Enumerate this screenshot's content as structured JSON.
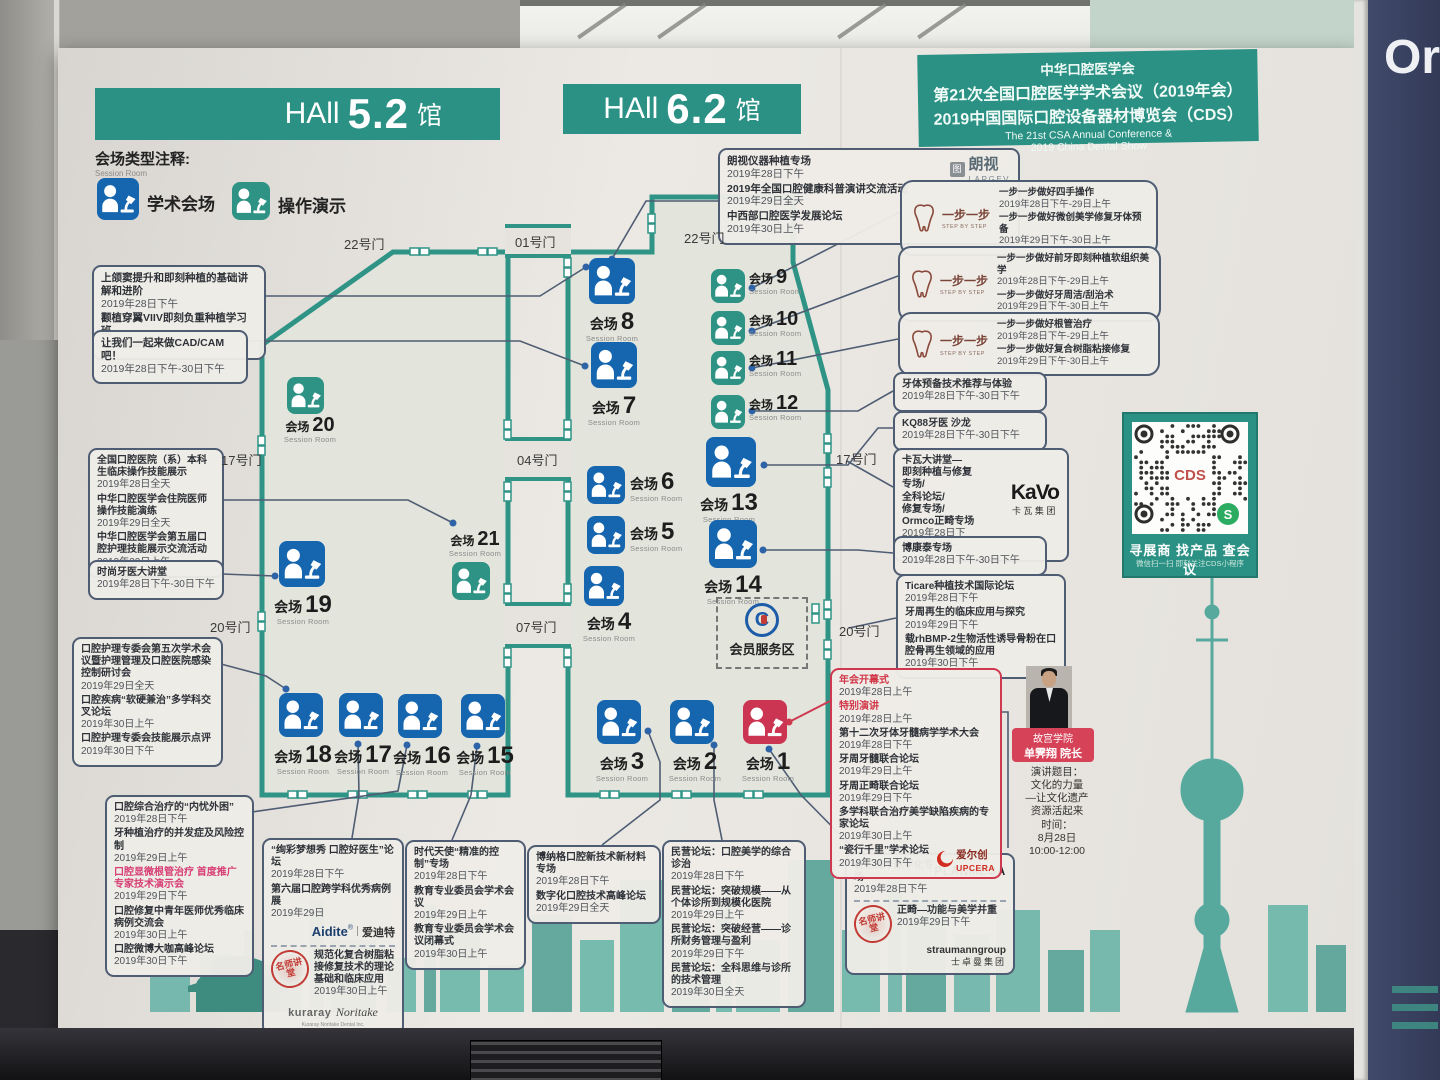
{
  "wall_text": "Or",
  "conference_header": {
    "l1": "中华口腔医学会",
    "l2": "第21次全国口腔医学学术会议（2019年会）",
    "l3": "2019中国国际口腔设备器材博览会（CDS）",
    "l4": "The 21st CSA Annual Conference &",
    "l5": "2019 China Dental Show"
  },
  "hall_titles": {
    "h52": {
      "pre": "HAll",
      "num": "5.2",
      "post": "馆"
    },
    "h62": {
      "pre": "HAll",
      "num": "6.2",
      "post": "馆"
    }
  },
  "legend": {
    "title": "会场类型注释:",
    "subtitle": "Session Room",
    "academic": "学术会场",
    "demo": "操作演示"
  },
  "room_label": "会场",
  "room_sub": "Session Room",
  "rooms": [
    {
      "num": "1",
      "type": "red"
    },
    {
      "num": "2",
      "type": "blue"
    },
    {
      "num": "3",
      "type": "blue"
    },
    {
      "num": "4",
      "type": "blue"
    },
    {
      "num": "5",
      "type": "blue"
    },
    {
      "num": "6",
      "type": "blue"
    },
    {
      "num": "7",
      "type": "blue"
    },
    {
      "num": "8",
      "type": "blue"
    },
    {
      "num": "9",
      "type": "teal"
    },
    {
      "num": "10",
      "type": "teal"
    },
    {
      "num": "11",
      "type": "teal"
    },
    {
      "num": "12",
      "type": "teal"
    },
    {
      "num": "13",
      "type": "blue"
    },
    {
      "num": "14",
      "type": "blue"
    },
    {
      "num": "15",
      "type": "blue"
    },
    {
      "num": "16",
      "type": "blue"
    },
    {
      "num": "17",
      "type": "blue"
    },
    {
      "num": "18",
      "type": "blue"
    },
    {
      "num": "19",
      "type": "blue"
    },
    {
      "num": "20",
      "type": "teal"
    },
    {
      "num": "21",
      "type": "teal"
    }
  ],
  "doors": [
    "22号门",
    "01号门",
    "22号门",
    "04号门",
    "07号门",
    "17号门",
    "20号门",
    "17号门",
    "20号门"
  ],
  "member_area": {
    "label": "会员服务区"
  },
  "qr": {
    "title": "寻展商 找产品 查会议",
    "subtitle": "微信扫一扫 即刻关注CDS小程序",
    "center": "CDS",
    "wechat": "S"
  },
  "speaker": {
    "org": "故宫学院",
    "name": "单霁翔 院长",
    "lines": [
      "演讲题目：",
      "文化的力量",
      "—让文化遗产",
      "资源活起来",
      "时间：",
      "8月28日",
      "10:00-12:00"
    ]
  },
  "logos": {
    "largev": {
      "cn": "朗视",
      "en": "LARGEV",
      "ic": "图"
    },
    "step": {
      "cn": "一步一步",
      "en": "STEP BY STEP"
    },
    "kavo": {
      "en": "KaVo",
      "cn": "卡瓦集团"
    },
    "upcera": {
      "cn": "爱尔创",
      "en": "UPCERA"
    },
    "aidite": {
      "en": "Aidite",
      "cn": "爱迪特"
    },
    "mingshi": {
      "cn": "名师讲堂"
    },
    "kuraray": {
      "en1": "kuraray",
      "en2": "Noritake",
      "tag": "Kuraray Noritake Dental Inc."
    },
    "planmeca": {
      "en": "PLANMECA"
    },
    "straumann": {
      "en": "straumanngroup",
      "cn": "士卓曼集团"
    },
    "csa_c": "C"
  },
  "boxes": {
    "b1": {
      "lines": [
        {
          "t": "上颌窦提升和即刻种植的基础讲解和进阶",
          "d": "2019年28日下午"
        },
        {
          "t": "颧植穿翼VIIV即刻负重种植学习班",
          "d": "2019年29日全天"
        }
      ]
    },
    "b2": {
      "lines": [
        {
          "t": "让我们一起来做CAD/CAM吧！",
          "d": "2019年28日下午-30日下午"
        }
      ]
    },
    "b3": {
      "lines": [
        {
          "t": "全国口腔医院（系）本科生临床操作技能展示",
          "d": "2019年28日全天"
        },
        {
          "t": "中华口腔医学会住院医师操作技能演练",
          "d": "2019年29日全天"
        },
        {
          "t": "中华口腔医学会第五届口腔护理技能展示交流活动",
          "d": "2019年30日上午"
        }
      ]
    },
    "b4": {
      "lines": [
        {
          "t": "时尚牙医大讲堂",
          "d": "2019年28日下午-30日下午"
        }
      ]
    },
    "b5": {
      "lines": [
        {
          "t": "口腔护理专委会第五次学术会议暨护理管理及口腔医院感染控制研讨会",
          "d": "2019年29日全天"
        },
        {
          "t": "口腔疾病“软硬兼治”多学科交叉论坛",
          "d": "2019年30日上午"
        },
        {
          "t": "口腔护理专委会技能展示点评",
          "d": "2019年30日下午"
        }
      ]
    },
    "b6": {
      "lines": [
        {
          "t": "口腔综合治疗的“内忧外困”",
          "d": "2019年28日下午"
        },
        {
          "t": "牙种植治疗的并发症及风险控制",
          "d": "2019年29日上午"
        },
        {
          "t": "口腔显微根管治疗 首度推广专家技术演示会",
          "d": "2019年29日下午",
          "red": true
        },
        {
          "t": "口腔修复中青年医师优秀临床病例交流会",
          "d": "2019年30日上午"
        },
        {
          "t": "口腔微博大咖高峰论坛",
          "d": "2019年30日下午"
        }
      ]
    },
    "b7": {
      "lines": [
        {
          "t": "“绚彩梦想秀 口腔好医生”论坛",
          "d": "2019年28日下午"
        },
        {
          "t": "第六届口腔跨学科优秀病例展",
          "d": "2019年29日"
        },
        {
          "t": "规范化复合树脂粘接修复技术的理论基础和临床应用",
          "d": "2019年30日上午"
        }
      ]
    },
    "b8": {
      "lines": [
        {
          "t": "时代天使“精准的控制”专场",
          "d": "2019年28日下午"
        },
        {
          "t": "教育专业委员会学术会议",
          "d": "2019年29日上午"
        },
        {
          "t": "教育专业委员会学术会议闭幕式",
          "d": "2019年30日上午"
        }
      ]
    },
    "b9": {
      "lines": [
        {
          "t": "博纳格口腔新技术新材料专场",
          "d": "2019年28日下午"
        },
        {
          "t": "数字化口腔技术高峰论坛",
          "d": "2019年29日全天"
        }
      ]
    },
    "b10": {
      "lines": [
        {
          "t": "民营论坛：口腔美学的综合诊治",
          "d": "2019年28日下午"
        },
        {
          "t": "民营论坛：突破规模——从个体诊所到规模化医院",
          "d": "2019年29日上午"
        },
        {
          "t": "民营论坛：突破经营——诊所财务管理与盈利",
          "d": "2019年29日下午"
        },
        {
          "t": "民营论坛：全科思维与诊所的技术管理",
          "d": "2019年30日全天"
        }
      ]
    },
    "b11": {
      "lines": [
        {
          "t": "普兰梅卡数字化专场",
          "d": "2019年28日下午"
        },
        {
          "t": "正畸—功能与美学并重",
          "d": "2019年29日下午"
        }
      ]
    },
    "b12": {
      "lines": [
        {
          "t": "朗视仪器种植专场",
          "d": "2019年28日下午"
        },
        {
          "t": "2019年全国口腔健康科普演讲交流活动",
          "d": "2019年29日全天"
        },
        {
          "t": "中西部口腔医学发展论坛",
          "d": "2019年30日上午"
        }
      ]
    },
    "b13": {
      "lines": [
        {
          "t": "一步一步做好四手操作",
          "d": "2019年28日下午-29日上午"
        },
        {
          "t": "一步一步做好微创美学修复牙体预备",
          "d": "2019年29日下午-30日上午"
        }
      ]
    },
    "b14": {
      "lines": [
        {
          "t": "一步一步做好前牙即刻种植软组织美学",
          "d": "2019年28日下午-29日上午"
        },
        {
          "t": "一步一步做好牙周洁/刮治术",
          "d": "2019年29日下午-30日上午"
        }
      ]
    },
    "b15": {
      "lines": [
        {
          "t": "一步一步做好根管治疗",
          "d": "2019年28日下午-29日上午"
        },
        {
          "t": "一步一步做好复合树脂粘接修复",
          "d": "2019年29日下午-30日上午"
        }
      ]
    },
    "b16": {
      "lines": [
        {
          "t": "牙体预备技术推荐与体验",
          "d": "2019年28日下午-30日下午"
        }
      ]
    },
    "b17": {
      "lines": [
        {
          "t": "KQ88牙医 沙龙",
          "d": "2019年28日下午-30日下午"
        }
      ]
    },
    "b18": {
      "lines": [
        {
          "t": "卡瓦大讲堂—"
        },
        {
          "t": "即刻种植与修复专场/"
        },
        {
          "t": "全科论坛/"
        },
        {
          "t": "修复专场/"
        },
        {
          "t": "Ormco正畸专场",
          "d": "2019年28日下午-30日上午"
        }
      ]
    },
    "b19": {
      "lines": [
        {
          "t": "博康泰专场",
          "d": "2019年28日下午-30日下午"
        }
      ]
    },
    "b20": {
      "lines": [
        {
          "t": "Ticare种植技术国际论坛",
          "d": "2019年28日下午"
        },
        {
          "t": "牙周再生的临床应用与探究",
          "d": "2019年29日下午"
        },
        {
          "t": "载rhBMP-2生物活性诱导骨粉在口腔骨再生领域的应用",
          "d": "2019年30日下午"
        }
      ]
    },
    "b21": {
      "lines": [
        {
          "t": "年会开幕式",
          "d": "2019年28日上午",
          "red": true
        },
        {
          "t": "特别演讲",
          "d": "2019年28日上午",
          "red": true
        },
        {
          "t": "第十二次牙体牙髓病学学术大会",
          "d": "2019年28日下午"
        },
        {
          "t": "牙周牙髓联合论坛",
          "d": "2019年29日上午"
        },
        {
          "t": "牙周正畸联合论坛",
          "d": "2019年29日下午"
        },
        {
          "t": "多学科联合治疗美学缺陷疾病的专家论坛",
          "d": "2019年30日上午"
        },
        {
          "t": "“瓷行千里”学术论坛",
          "d": "2019年30日下午"
        }
      ]
    }
  }
}
